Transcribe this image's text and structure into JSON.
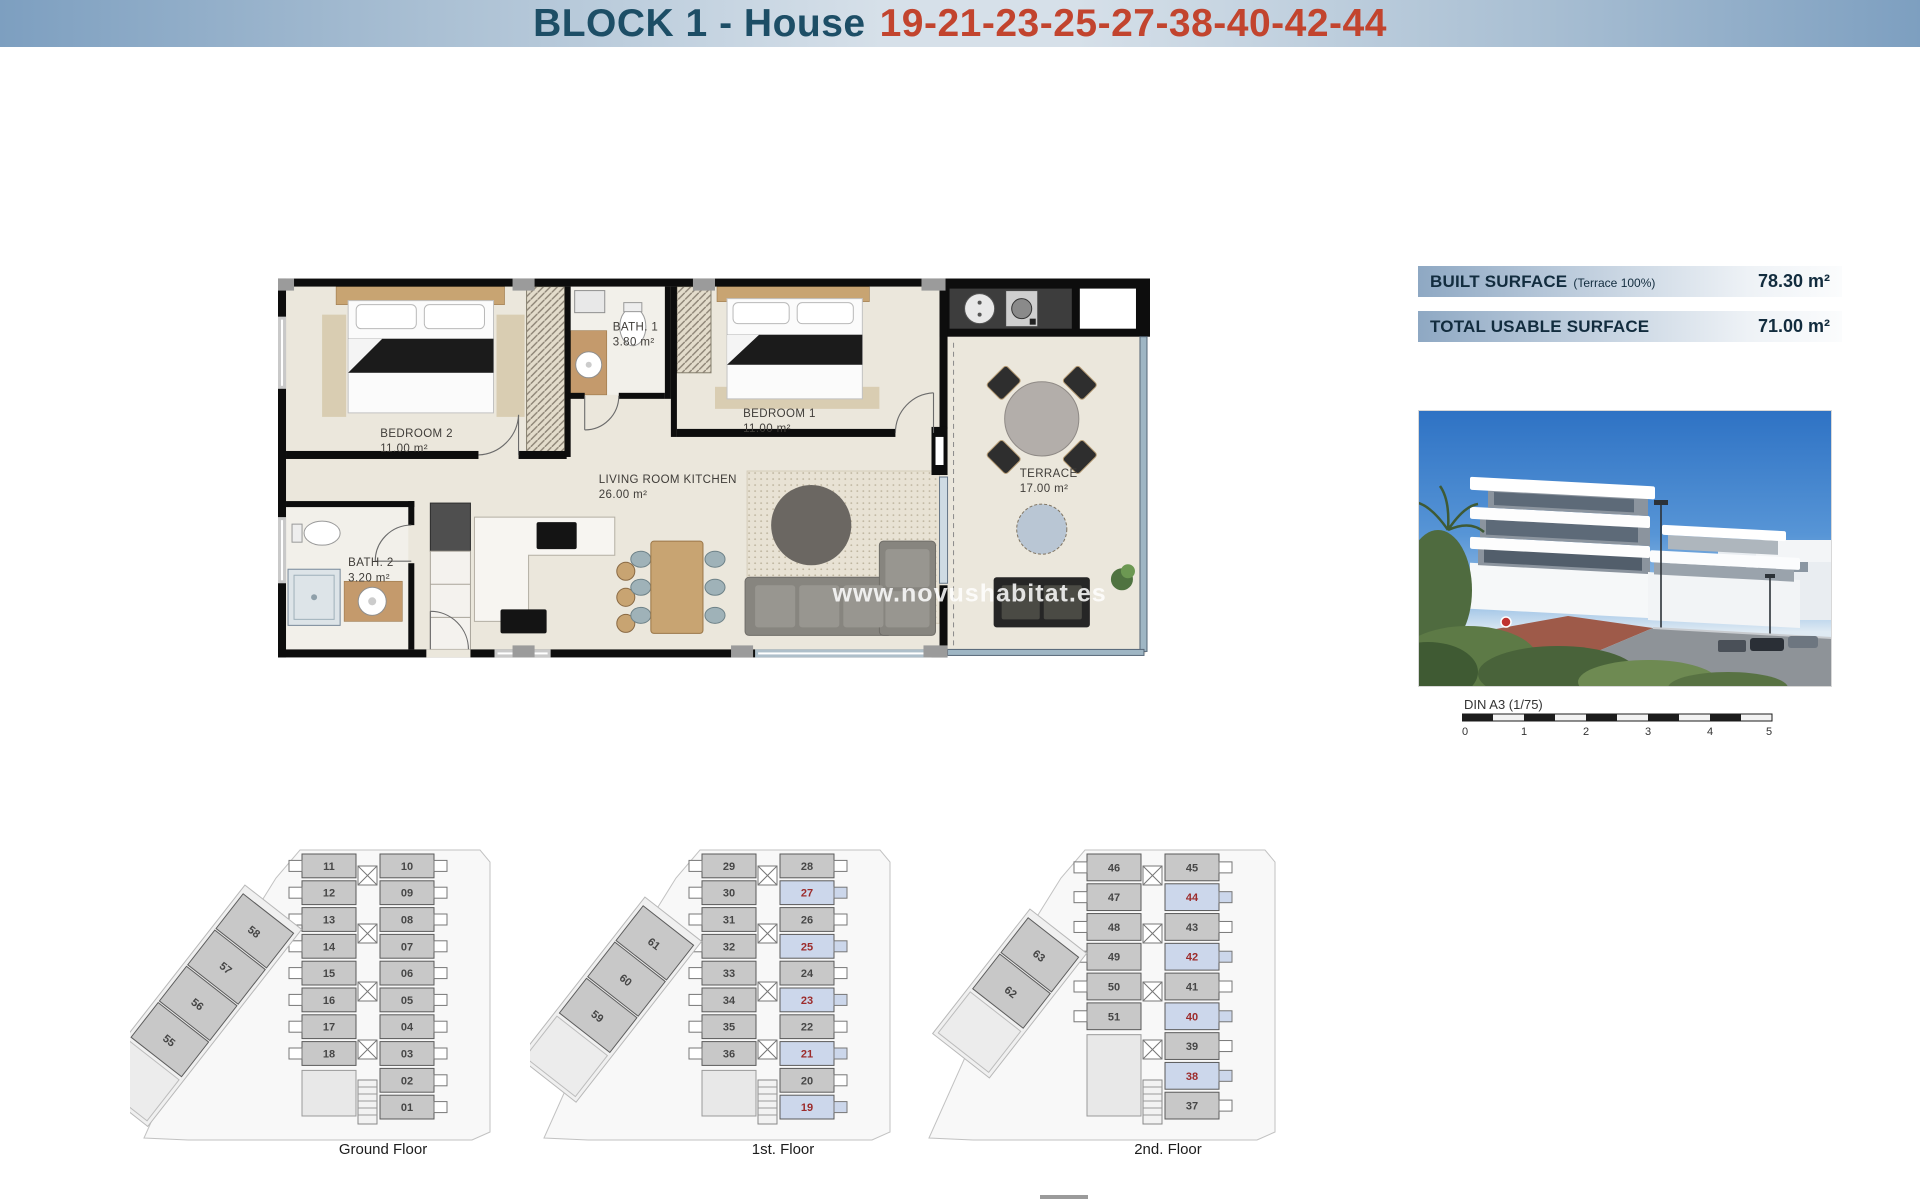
{
  "header": {
    "block_label": "BLOCK 1 - House",
    "house_numbers": "19-21-23-25-27-38-40-42-44"
  },
  "surface_info": {
    "built": {
      "label": "BUILT SURFACE",
      "note": "(Terrace 100%)",
      "value": "78.30 m²"
    },
    "usable": {
      "label": "TOTAL USABLE SURFACE",
      "value": "71.00 m²"
    }
  },
  "floor_plan": {
    "watermark": "www.novushabitat.es",
    "rooms": [
      {
        "name": "BEDROOM 2",
        "area": "11.00 m²"
      },
      {
        "name": "BATH. 1",
        "area": "3.80 m²"
      },
      {
        "name": "BEDROOM 1",
        "area": "11.00 m²"
      },
      {
        "name": "LIVING ROOM KITCHEN",
        "area": "26.00 m²"
      },
      {
        "name": "BATH. 2",
        "area": "3.20 m²"
      },
      {
        "name": "TERRACE",
        "area": "17.00 m²"
      }
    ]
  },
  "scale_bar": {
    "label": "DIN A3 (1/75)",
    "ticks": [
      "0",
      "1",
      "2",
      "3",
      "4",
      "5"
    ]
  },
  "floors": [
    {
      "caption": "Ground Floor",
      "left_units": [
        "11",
        "12",
        "13",
        "14",
        "15",
        "16",
        "17",
        "18"
      ],
      "right_units": [
        {
          "n": "10",
          "hl": false
        },
        {
          "n": "09",
          "hl": false
        },
        {
          "n": "08",
          "hl": false
        },
        {
          "n": "07",
          "hl": false
        },
        {
          "n": "06",
          "hl": false
        },
        {
          "n": "05",
          "hl": false
        },
        {
          "n": "04",
          "hl": false
        },
        {
          "n": "03",
          "hl": false
        },
        {
          "n": "02",
          "hl": false
        },
        {
          "n": "01",
          "hl": false
        }
      ],
      "diagonal_units": [
        "58",
        "57",
        "56",
        "55"
      ]
    },
    {
      "caption": "1st. Floor",
      "left_units": [
        "29",
        "30",
        "31",
        "32",
        "33",
        "34",
        "35",
        "36"
      ],
      "right_units": [
        {
          "n": "28",
          "hl": false
        },
        {
          "n": "27",
          "hl": true
        },
        {
          "n": "26",
          "hl": false
        },
        {
          "n": "25",
          "hl": true
        },
        {
          "n": "24",
          "hl": false
        },
        {
          "n": "23",
          "hl": true
        },
        {
          "n": "22",
          "hl": false
        },
        {
          "n": "21",
          "hl": true
        },
        {
          "n": "20",
          "hl": false
        },
        {
          "n": "19",
          "hl": true
        }
      ],
      "diagonal_units": [
        "61",
        "60",
        "59"
      ]
    },
    {
      "caption": "2nd. Floor",
      "left_units": [
        "46",
        "47",
        "48",
        "49",
        "50",
        "51"
      ],
      "right_units": [
        {
          "n": "45",
          "hl": false
        },
        {
          "n": "44",
          "hl": true
        },
        {
          "n": "43",
          "hl": false
        },
        {
          "n": "42",
          "hl": true
        },
        {
          "n": "41",
          "hl": false
        },
        {
          "n": "40",
          "hl": true
        },
        {
          "n": "39",
          "hl": false
        },
        {
          "n": "38",
          "hl": true
        },
        {
          "n": "37",
          "hl": false
        }
      ],
      "diagonal_units": [
        "63",
        "62"
      ]
    }
  ],
  "palette": {
    "header_text": "#1d4e66",
    "header_numbers": "#c2442e",
    "bar_text": "#122c3e",
    "plan_floor": "#ebe7dc",
    "wall": "#0d0d0d",
    "wood": "#c8a472",
    "unit_fill": "#c8c8c8",
    "highlight_unit": "#ccd7eb",
    "highlight_number": "#9c2b2b"
  }
}
